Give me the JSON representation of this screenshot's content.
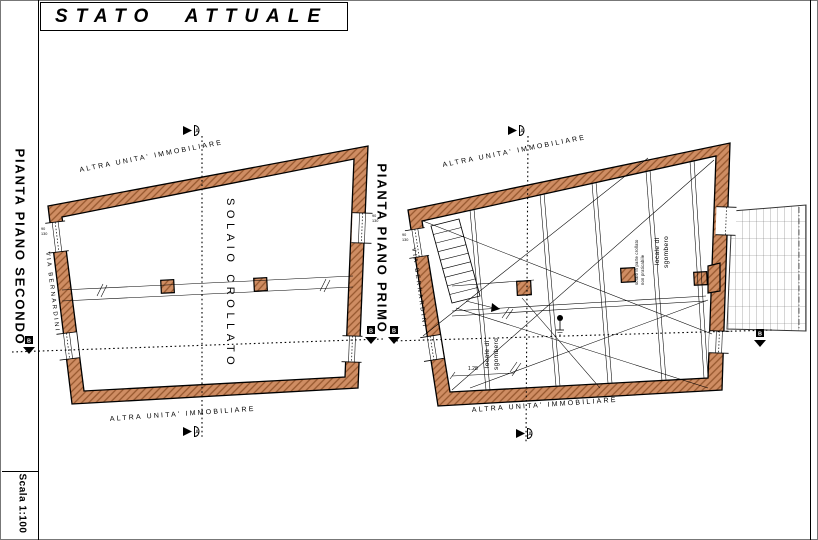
{
  "page": {
    "title": "STATO ATTUALE",
    "scale_label": "Scala 1:100"
  },
  "second_floor_plan": {
    "title": "PIANTA PIANO SECONDO",
    "top_boundary_label": "ALTRA UNITA' IMMOBILIARE",
    "bottom_boundary_label": "ALTRA UNITA' IMMOBILIARE",
    "street_label": "VIA BERNARDINI",
    "room_label": "SOLAIO CROLLATO"
  },
  "first_floor_plan": {
    "title": "PIANTA PIANO PRIMO",
    "top_boundary_label": "ALTRA UNITA' IMMOBILIARE",
    "bottom_boundary_label": "ALTRA UNITA' IMMOBILIARE",
    "street_label": "VIA BERNARDINI",
    "storage_room_upper": {
      "line1": "locale di",
      "line2": "sgombero"
    },
    "storage_room_upper_note": {
      "line1": "solaio in parte crollato",
      "line2": "non praticabile"
    },
    "storage_room_lower": {
      "line1": "locale di",
      "line2": "sgombero"
    },
    "dimension_width": "1.28"
  },
  "annotations": {
    "window_width": "90",
    "window_height": "130",
    "section_a": "A",
    "section_b": "B"
  },
  "colors": {
    "wall_fill": "#cf8d63",
    "wall_hatch": "#96572e",
    "line": "#000000"
  }
}
